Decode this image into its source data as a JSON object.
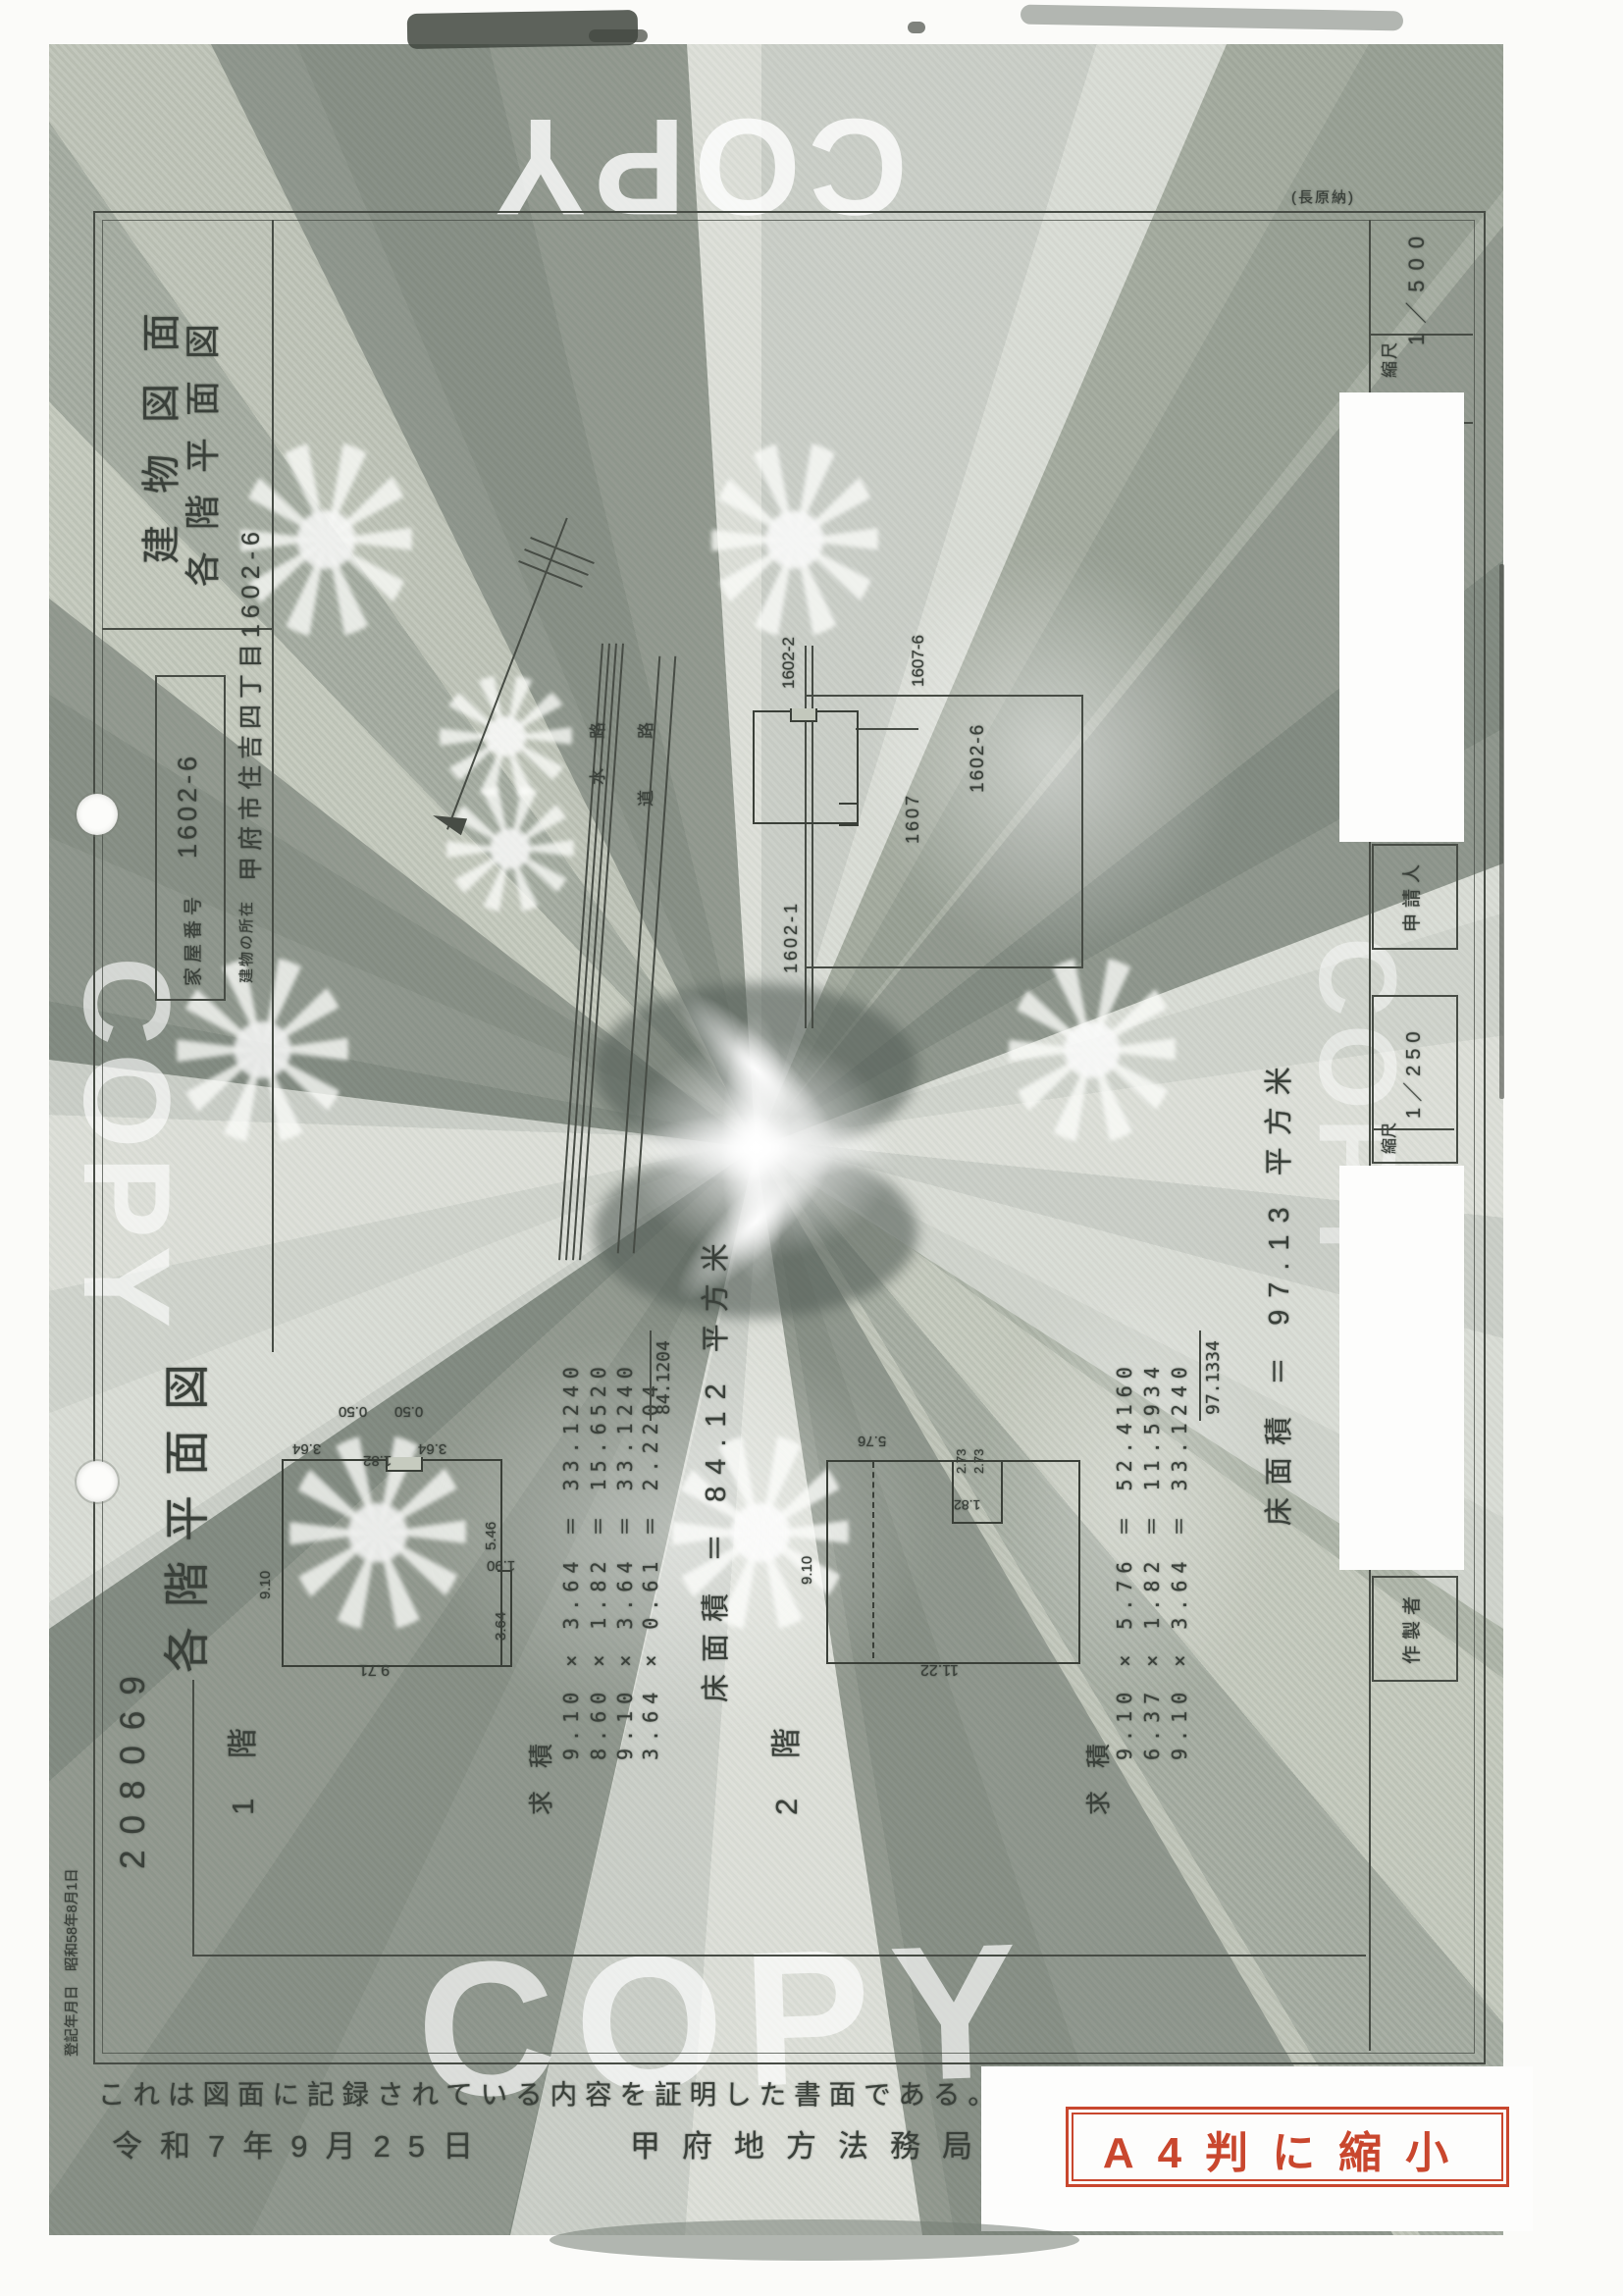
{
  "watermark": {
    "text": "COPY"
  },
  "header": {
    "title_line1": "建物図面",
    "title_line2": "各階平面図",
    "house_number_label": "家屋番号",
    "house_number": "1602-6",
    "location_label": "建物の所在",
    "location": "甲府市住吉四丁目1602-6",
    "corner_note": "(長原納)"
  },
  "site_plan": {
    "waterway_label": "水路",
    "road_label": "道路",
    "parcel_main": "1602-6",
    "parcel_top": "1602-2",
    "parcel_right_top": "1607-6",
    "parcel_right": "1607",
    "parcel_bottom": "1602-1"
  },
  "section": {
    "header": "各階平面図",
    "page_number": "208069"
  },
  "floor1": {
    "label": "1 階",
    "kyuseki_label": "求 積",
    "calc_lines": [
      "9.10 × 3.64 ＝ 33.1240",
      "8.60 × 1.82 ＝ 15.6520",
      "9.10 × 3.64 ＝ 33.1240",
      "3.64 × 0.61 ＝ 2.2204"
    ],
    "total": "84.1204",
    "area_line": "床面積 ＝ 84.12 平方米",
    "dims": {
      "offset1": "0.50",
      "offset2": "0.50",
      "top1": "3.64",
      "top2": "1.82",
      "top3": "3.64",
      "left": "9.10",
      "right1": "5.46",
      "right2": "1.90",
      "right3": "3.64",
      "bottom": "9.71"
    }
  },
  "floor2": {
    "label": "2 階",
    "kyuseki_label": "求 積",
    "calc_lines": [
      "9.10 × 5.76 ＝ 52.4160",
      "6.37 × 1.82 ＝ 11.5934",
      "9.10 × 3.64 ＝ 33.1240"
    ],
    "total": "97.1334",
    "area_line": "床面積 ＝ 97.13 平方米",
    "dims": {
      "top": "5.76",
      "notch1": "2.73",
      "notch2": "2.73",
      "notch_inner": "1.82",
      "left": "9.10",
      "bottom": "11.22"
    }
  },
  "form": {
    "scale1_label": "縮尺",
    "scale1_value": "1／500",
    "applicant_label": "申請人",
    "scale2_label": "縮尺",
    "scale2_value": "1／250",
    "maker_label": "作製者",
    "payment_number": "納付番号：10-2",
    "registration_note": "登記年月日　昭和58年8月1日"
  },
  "certification": {
    "statement": "これは図面に記録されている内容を証明した書面である。",
    "date": "令和7年9月25日",
    "office": "甲府地方法務局"
  },
  "stamp": {
    "text": "A4判に縮小",
    "color": "#c9472e"
  }
}
